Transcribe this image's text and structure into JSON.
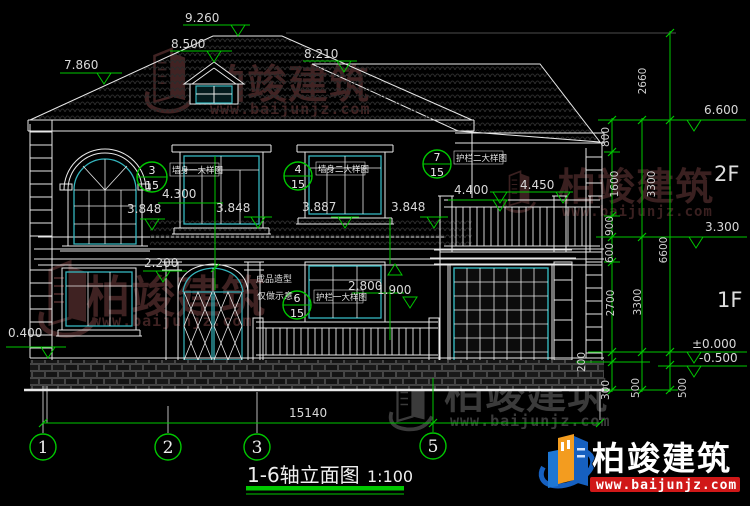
{
  "title": {
    "name": "1-6轴立面图",
    "scale": "1:100"
  },
  "total_width_dim": "15140",
  "axes": [
    "1",
    "2",
    "3",
    "5"
  ],
  "floors": {
    "second": "2F",
    "first": "1F"
  },
  "marks": [
    "9.260",
    "8.500",
    "8.210",
    "7.860",
    "6.600",
    "3.300",
    "±0.000",
    "-0.500",
    "0.400",
    "4.300",
    "3.848",
    "3.848",
    "3.887",
    "3.848",
    "4.400",
    "4.450",
    "2.200",
    "2.800",
    "1.900"
  ],
  "chains": [
    "2660",
    "800",
    "1600",
    "3300",
    "900",
    "600",
    "6600",
    "2700",
    "3300",
    "200",
    "300",
    "500",
    "500"
  ],
  "callouts": [
    {
      "num": "3",
      "den": "15",
      "label": "墙身一大样图"
    },
    {
      "num": "4",
      "den": "15",
      "label": "墙身二大样图"
    },
    {
      "num": "7",
      "den": "15",
      "label": "护栏二大样图"
    },
    {
      "num": "6",
      "den": "15",
      "label": "护栏一大样图"
    }
  ],
  "notes": [
    "成品造型",
    "仅做示意"
  ],
  "watermark": {
    "brand": "柏竣建筑",
    "url": "www.baijunjz.com"
  },
  "logo": {
    "brand": "柏竣建筑",
    "url": "www.baijunjz.com"
  },
  "colors": {
    "annotation_green": "#00c800",
    "frame_cyan": "#35b6be",
    "line_white": "#e8e8e8",
    "watermark_red": "#412323",
    "watermark_gray": "#3b3b3b",
    "logo_blue": "#1660c0",
    "logo_orange": "#f39c1f",
    "logo_red": "#d01818"
  }
}
